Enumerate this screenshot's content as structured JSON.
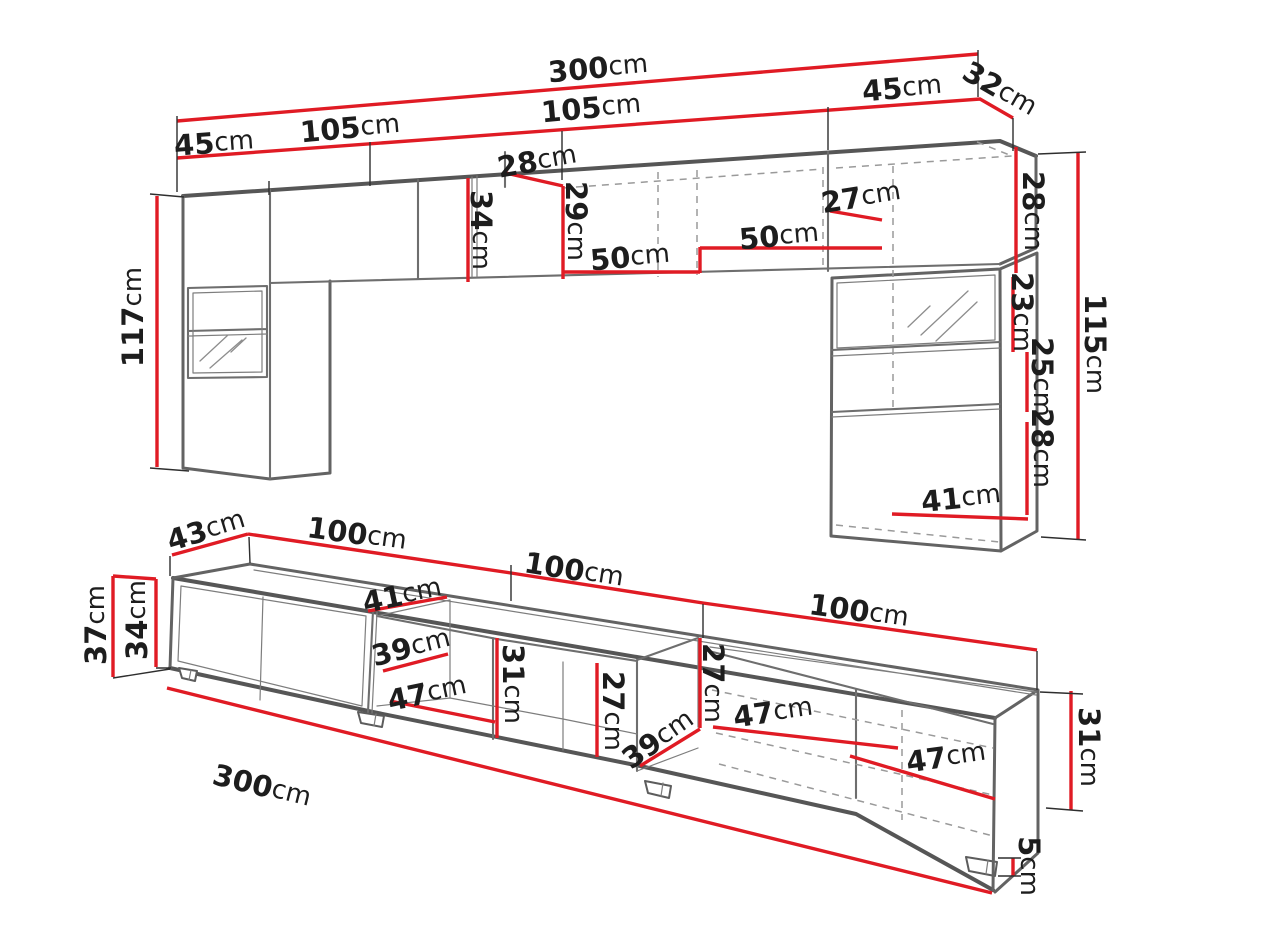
{
  "diagram": {
    "type": "furniture-dimension-drawing",
    "unit": "cm",
    "colors": {
      "dimension_line": "#e01b24",
      "outline": "#636363",
      "hidden_line": "#9a9a9a",
      "label_text": "#1d1d1d",
      "background": "#ffffff"
    },
    "labels": {
      "top": {
        "overall_width": {
          "value": "300",
          "unit": "cm"
        },
        "left_section_width": {
          "value": "105",
          "unit": "cm"
        },
        "left_column_width": {
          "value": "45",
          "unit": "cm"
        },
        "right_section_width": {
          "value": "105",
          "unit": "cm"
        },
        "right_column_width": {
          "value": "45",
          "unit": "cm"
        },
        "corner_depth": {
          "value": "32",
          "unit": "cm"
        },
        "center_cabinet_depth": {
          "value": "28",
          "unit": "cm"
        },
        "center_cabinet_height": {
          "value": "34",
          "unit": "cm"
        },
        "center_inner_height": {
          "value": "29",
          "unit": "cm"
        },
        "shelf_width_left": {
          "value": "50",
          "unit": "cm"
        },
        "shelf_width_right": {
          "value": "50",
          "unit": "cm"
        },
        "right_cabinet_depth": {
          "value": "27",
          "unit": "cm"
        },
        "left_column_height": {
          "value": "117",
          "unit": "cm"
        },
        "right_top_cabinet_height": {
          "value": "28",
          "unit": "cm"
        },
        "glass_door_height": {
          "value": "23",
          "unit": "cm"
        },
        "open_shelf_height": {
          "value": "25",
          "unit": "cm"
        },
        "lower_door_height": {
          "value": "28",
          "unit": "cm"
        },
        "right_column_height": {
          "value": "115",
          "unit": "cm"
        },
        "right_inner_width": {
          "value": "41",
          "unit": "cm"
        }
      },
      "bottom": {
        "depth": {
          "value": "43",
          "unit": "cm"
        },
        "width_left": {
          "value": "100",
          "unit": "cm"
        },
        "width_middle": {
          "value": "100",
          "unit": "cm"
        },
        "width_right": {
          "value": "100",
          "unit": "cm"
        },
        "top_inner_depth": {
          "value": "41",
          "unit": "cm"
        },
        "total_height": {
          "value": "37",
          "unit": "cm"
        },
        "body_height": {
          "value": "34",
          "unit": "cm"
        },
        "open_left_height": {
          "value": "31",
          "unit": "cm"
        },
        "open_left_depth": {
          "value": "39",
          "unit": "cm"
        },
        "open_left_width": {
          "value": "47",
          "unit": "cm"
        },
        "open_middle_height": {
          "value": "27",
          "unit": "cm"
        },
        "divider_depth": {
          "value": "39",
          "unit": "cm"
        },
        "open_right_height": {
          "value": "27",
          "unit": "cm"
        },
        "compartment_width_middle": {
          "value": "47",
          "unit": "cm"
        },
        "compartment_width_right": {
          "value": "47",
          "unit": "cm"
        },
        "right_end_height": {
          "value": "31",
          "unit": "cm"
        },
        "leg_height": {
          "value": "5",
          "unit": "cm"
        },
        "overall_width": {
          "value": "300",
          "unit": "cm"
        }
      }
    }
  }
}
